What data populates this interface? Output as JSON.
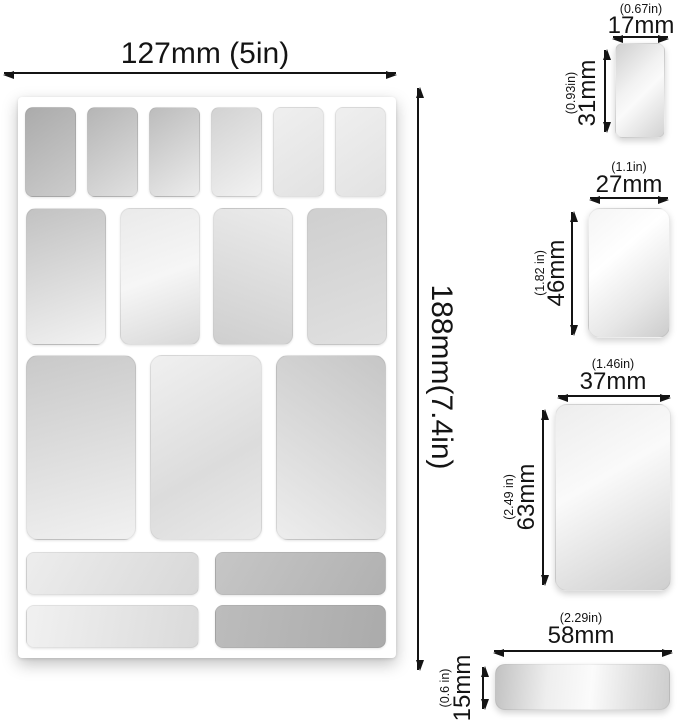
{
  "diagram": {
    "sheet": {
      "width_label": "127mm (5in)",
      "height_label": "188mm(7.4in)"
    },
    "pieces": {
      "small": {
        "width_in": "(0.67in)",
        "width_mm": "17mm",
        "height_in": "(0.93in)",
        "height_mm": "31mm"
      },
      "medium": {
        "width_in": "(1.1in)",
        "width_mm": "27mm",
        "height_in": "(1.82 in)",
        "height_mm": "46mm"
      },
      "large": {
        "width_in": "(1.46in)",
        "width_mm": "37mm",
        "height_in": "(2.49 in)",
        "height_mm": "63mm"
      },
      "strip": {
        "width_in": "(2.29in)",
        "width_mm": "58mm",
        "height_in": "(0.6 in)",
        "height_mm": "15mm"
      }
    },
    "sticker_counts": {
      "small": 6,
      "medium": 4,
      "large": 3,
      "strips": 4
    },
    "colors": {
      "line": "#141414",
      "sheet": "#ffffff"
    }
  }
}
